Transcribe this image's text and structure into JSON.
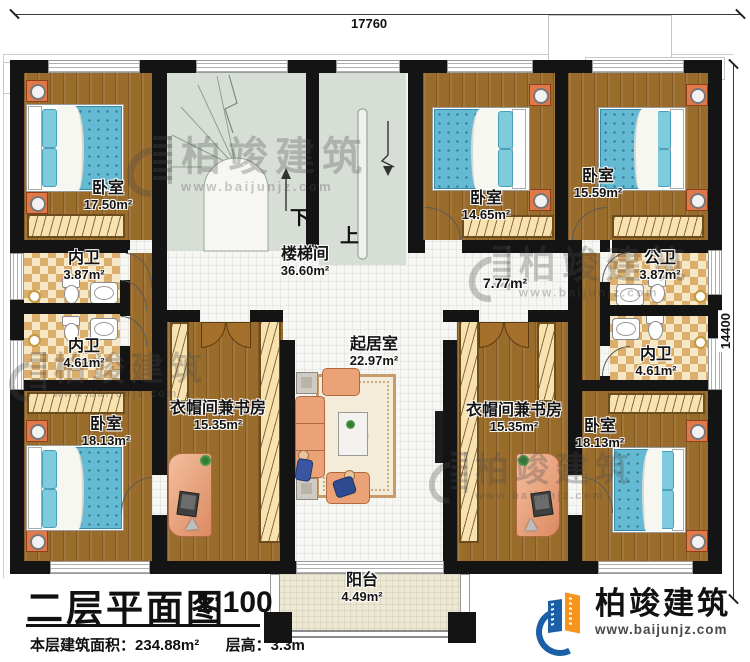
{
  "title_block": {
    "title": "二层平面图",
    "scale": "1:100",
    "area_label": "本层建筑面积：",
    "area_value": "234.88m²",
    "height_label": "层高：",
    "height_value": "3.3m"
  },
  "dimensions": {
    "top_width": "17760",
    "right_height": "14400"
  },
  "brand": {
    "name": "柏竣建筑",
    "url": "www.baijunjz.com"
  },
  "watermark": {
    "name": "柏竣建筑",
    "url": "www.baijunjz.com"
  },
  "stairs": {
    "down_label": "下",
    "up_label": "上"
  },
  "rooms": [
    {
      "id": "bedroom-top-left",
      "name": "卧室",
      "area": "17.50m²"
    },
    {
      "id": "stairwell",
      "name": "楼梯间",
      "area": "36.60m²"
    },
    {
      "id": "bedroom-top-middle",
      "name": "卧室",
      "area": "14.65m²"
    },
    {
      "id": "bedroom-top-right",
      "name": "卧室",
      "area": "15.59m²"
    },
    {
      "id": "hallway",
      "name": "",
      "area": "7.77m²"
    },
    {
      "id": "public-bath",
      "name": "公卫",
      "area": "3.87m²"
    },
    {
      "id": "bath-left-top",
      "name": "内卫",
      "area": "3.87m²"
    },
    {
      "id": "bath-left-bottom",
      "name": "内卫",
      "area": "4.61m²"
    },
    {
      "id": "bath-right",
      "name": "内卫",
      "area": "4.61m²"
    },
    {
      "id": "bedroom-bottom-left",
      "name": "卧室",
      "area": "18.13m²"
    },
    {
      "id": "cloak-study-left",
      "name": "衣帽间兼书房",
      "area": "15.35m²"
    },
    {
      "id": "living-room",
      "name": "起居室",
      "area": "22.97m²"
    },
    {
      "id": "cloak-study-right",
      "name": "衣帽间兼书房",
      "area": "15.35m²"
    },
    {
      "id": "bedroom-bottom-right",
      "name": "卧室",
      "area": "18.13m²"
    },
    {
      "id": "balcony",
      "name": "阳台",
      "area": "4.49m²"
    }
  ],
  "colors": {
    "wall": "#141414",
    "wood": "#9a6c2c",
    "stair_floor": "#d7ded6",
    "bath_tile": "#dcae6c",
    "bed_blue": "#64bad2",
    "brand_blue": "#1b5fa6",
    "brand_orange": "#f7941d"
  }
}
